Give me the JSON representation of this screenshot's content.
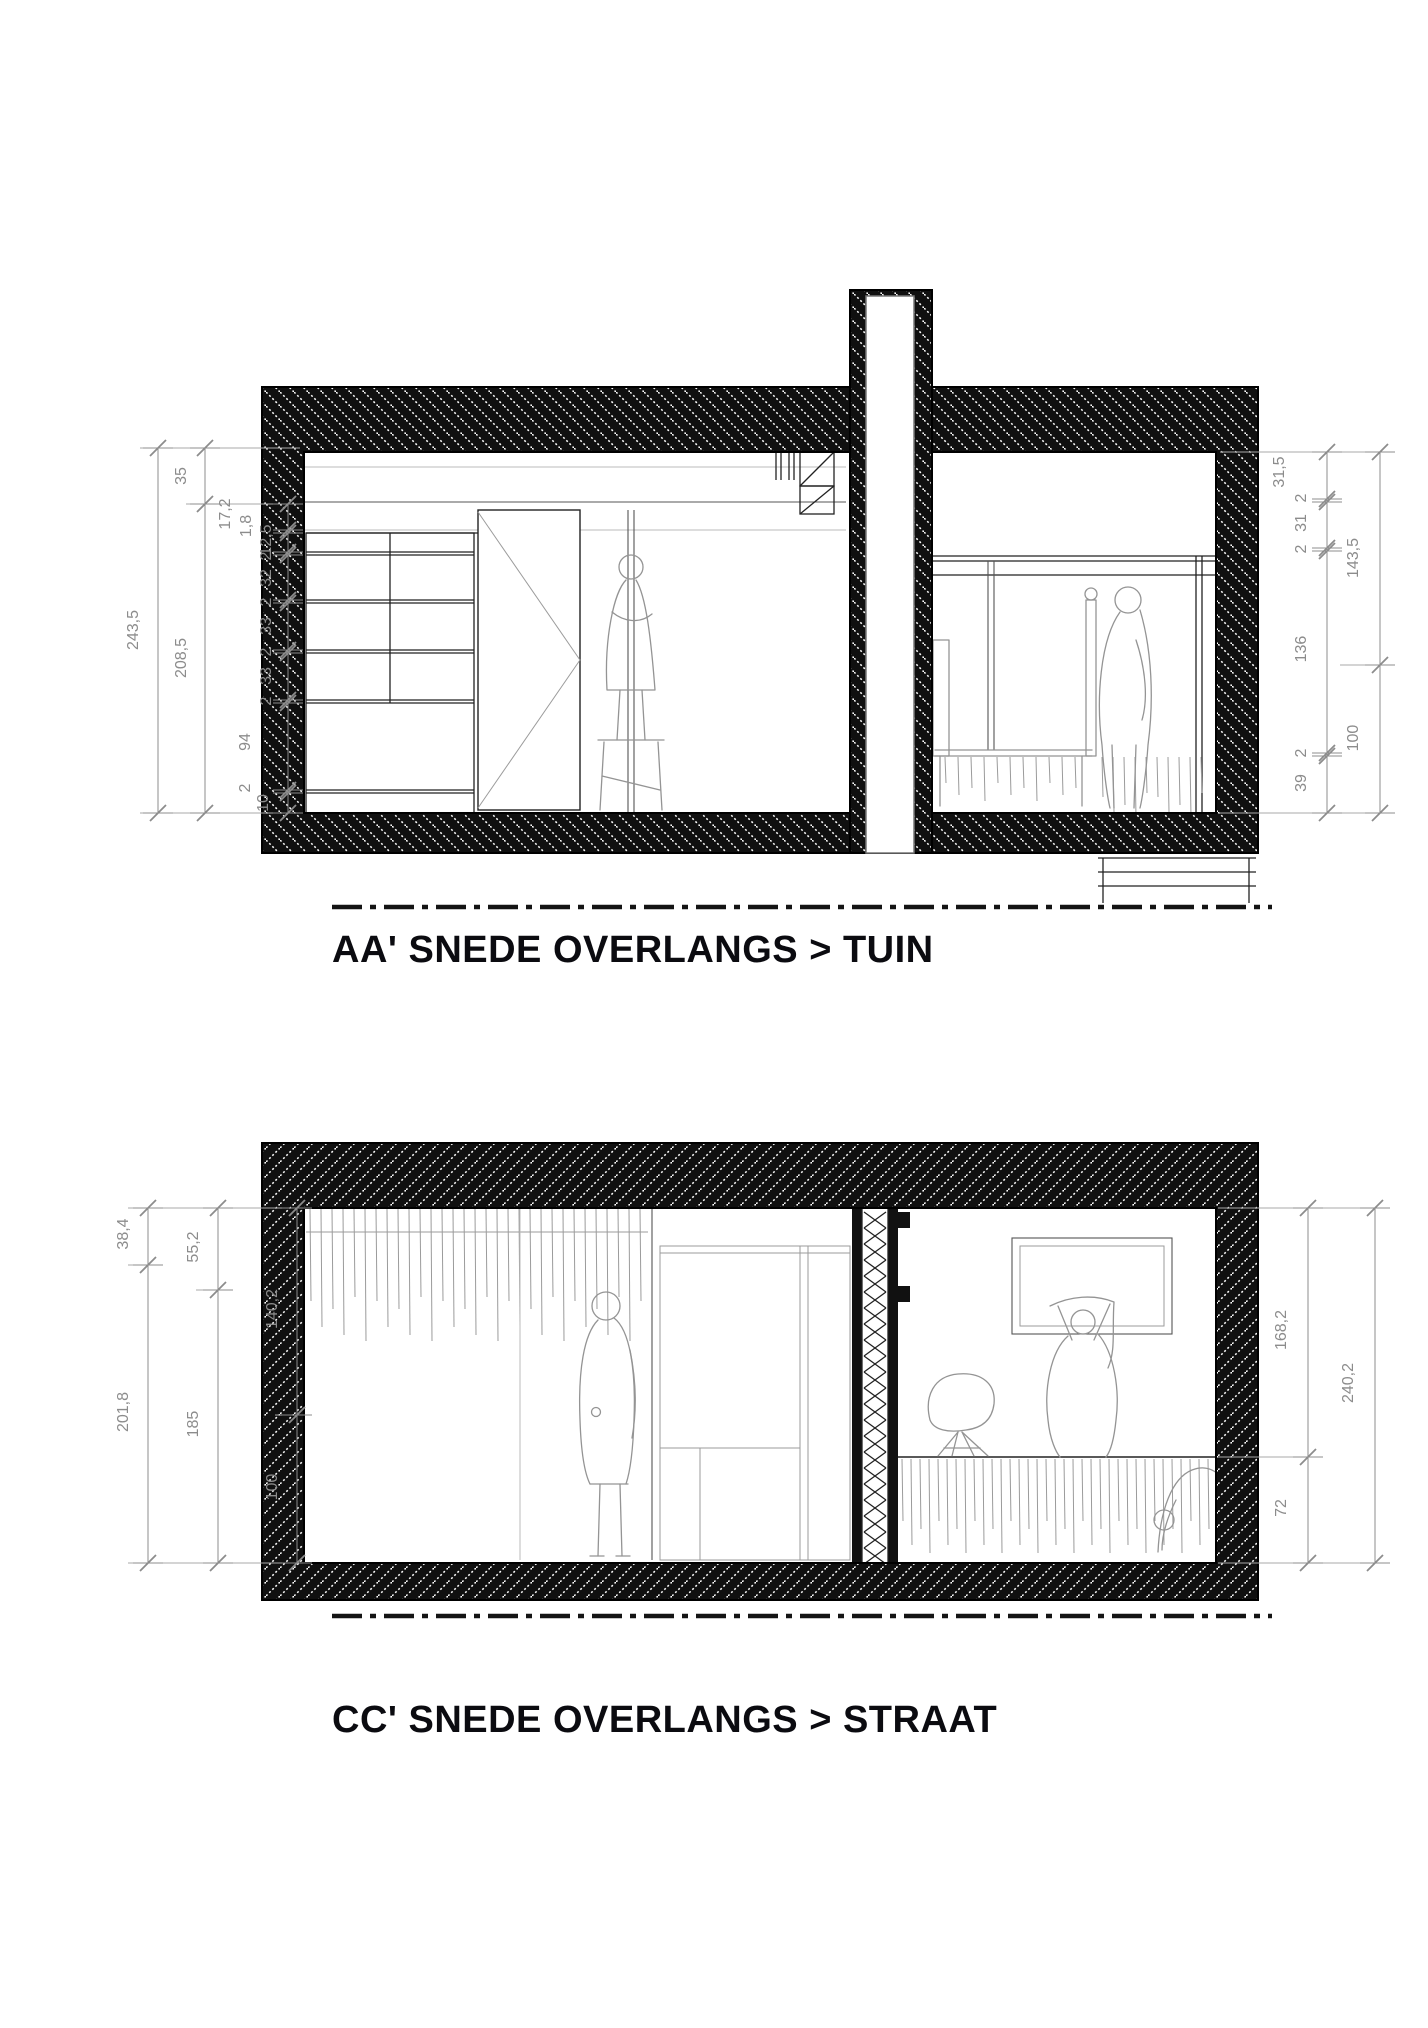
{
  "sections": [
    {
      "id": "AA",
      "title": "AA' SNEDE OVERLANGS > TUIN",
      "dims": {
        "left": [
          {
            "x": 158,
            "segments": [
              {
                "text": "243,5",
                "y1": 448,
                "y2": 813,
                "lx": 138,
                "ly": 630
              }
            ]
          },
          {
            "x": 205,
            "segments": [
              {
                "text": "35",
                "y1": 448,
                "y2": 504,
                "lx": 186,
                "ly": 476
              },
              {
                "text": "208,5",
                "y1": 504,
                "y2": 813,
                "lx": 186,
                "ly": 658
              }
            ]
          },
          {
            "x": 288,
            "segments": [
              {
                "text": "17,2",
                "y1": 504,
                "y2": 530,
                "lx": 230,
                "ly": 514
              },
              {
                "text": "1,8",
                "y1": 530,
                "y2": 533,
                "lx": 251,
                "ly": 526
              },
              {
                "text": "12,5",
                "y1": 533,
                "y2": 552,
                "lx": 271,
                "ly": 540
              },
              {
                "text": "2",
                "y1": 552,
                "y2": 555,
                "lx": 271,
                "ly": 556
              },
              {
                "text": "32",
                "y1": 555,
                "y2": 600,
                "lx": 271,
                "ly": 578
              },
              {
                "text": "2",
                "y1": 600,
                "y2": 603,
                "lx": 271,
                "ly": 602
              },
              {
                "text": "33",
                "y1": 603,
                "y2": 650,
                "lx": 271,
                "ly": 626
              },
              {
                "text": "2",
                "y1": 650,
                "y2": 653,
                "lx": 271,
                "ly": 652
              },
              {
                "text": "33",
                "y1": 653,
                "y2": 700,
                "lx": 271,
                "ly": 676
              },
              {
                "text": "2",
                "y1": 700,
                "y2": 703,
                "lx": 271,
                "ly": 701
              },
              {
                "text": "94",
                "y1": 703,
                "y2": 790,
                "lx": 250,
                "ly": 742
              },
              {
                "text": "2",
                "y1": 790,
                "y2": 793,
                "lx": 250,
                "ly": 788
              },
              {
                "text": "10",
                "y1": 793,
                "y2": 813,
                "lx": 268,
                "ly": 803
              }
            ]
          }
        ],
        "right": [
          {
            "x": 1327,
            "segments": [
              {
                "text": "31,5",
                "y1": 452,
                "y2": 499,
                "lx": 1284,
                "ly": 472
              },
              {
                "text": "2",
                "y1": 499,
                "y2": 502,
                "lx": 1306,
                "ly": 498
              },
              {
                "text": "31",
                "y1": 502,
                "y2": 548,
                "lx": 1306,
                "ly": 523
              },
              {
                "text": "2",
                "y1": 548,
                "y2": 551,
                "lx": 1306,
                "ly": 549
              },
              {
                "text": "136",
                "y1": 551,
                "y2": 753,
                "lx": 1306,
                "ly": 649
              },
              {
                "text": "2",
                "y1": 753,
                "y2": 756,
                "lx": 1306,
                "ly": 753
              },
              {
                "text": "39",
                "y1": 756,
                "y2": 813,
                "lx": 1306,
                "ly": 783
              }
            ]
          },
          {
            "x": 1380,
            "segments": [
              {
                "text": "143,5",
                "y1": 452,
                "y2": 665,
                "lx": 1358,
                "ly": 558
              },
              {
                "text": "100",
                "y1": 665,
                "y2": 813,
                "lx": 1358,
                "ly": 738
              }
            ]
          }
        ]
      }
    },
    {
      "id": "CC",
      "title": "CC' SNEDE OVERLANGS > STRAAT",
      "dims": {
        "left": [
          {
            "x": 148,
            "segments": [
              {
                "text": "38,4",
                "y1": 1208,
                "y2": 1265,
                "lx": 128,
                "ly": 1234
              },
              {
                "text": "201,8",
                "y1": 1265,
                "y2": 1563,
                "lx": 128,
                "ly": 1412
              }
            ]
          },
          {
            "x": 218,
            "segments": [
              {
                "text": "55,2",
                "y1": 1208,
                "y2": 1290,
                "lx": 198,
                "ly": 1247
              },
              {
                "text": "185",
                "y1": 1290,
                "y2": 1563,
                "lx": 198,
                "ly": 1424
              }
            ]
          },
          {
            "x": 297,
            "segments": [
              {
                "text": "140,2",
                "y1": 1208,
                "y2": 1415,
                "lx": 277,
                "ly": 1309
              },
              {
                "text": "100",
                "y1": 1415,
                "y2": 1563,
                "lx": 277,
                "ly": 1487
              }
            ]
          }
        ],
        "right": [
          {
            "x": 1308,
            "segments": [
              {
                "text": "168,2",
                "y1": 1208,
                "y2": 1457,
                "lx": 1286,
                "ly": 1330
              },
              {
                "text": "72",
                "y1": 1457,
                "y2": 1563,
                "lx": 1286,
                "ly": 1508
              }
            ]
          },
          {
            "x": 1375,
            "segments": [
              {
                "text": "240,2",
                "y1": 1208,
                "y2": 1563,
                "lx": 1353,
                "ly": 1383
              }
            ]
          }
        ]
      }
    }
  ],
  "colors": {
    "wall": "#101010",
    "dim": "#8c8c8c",
    "furniture": "#949494",
    "title": "#0b0b10",
    "background": "#ffffff"
  }
}
